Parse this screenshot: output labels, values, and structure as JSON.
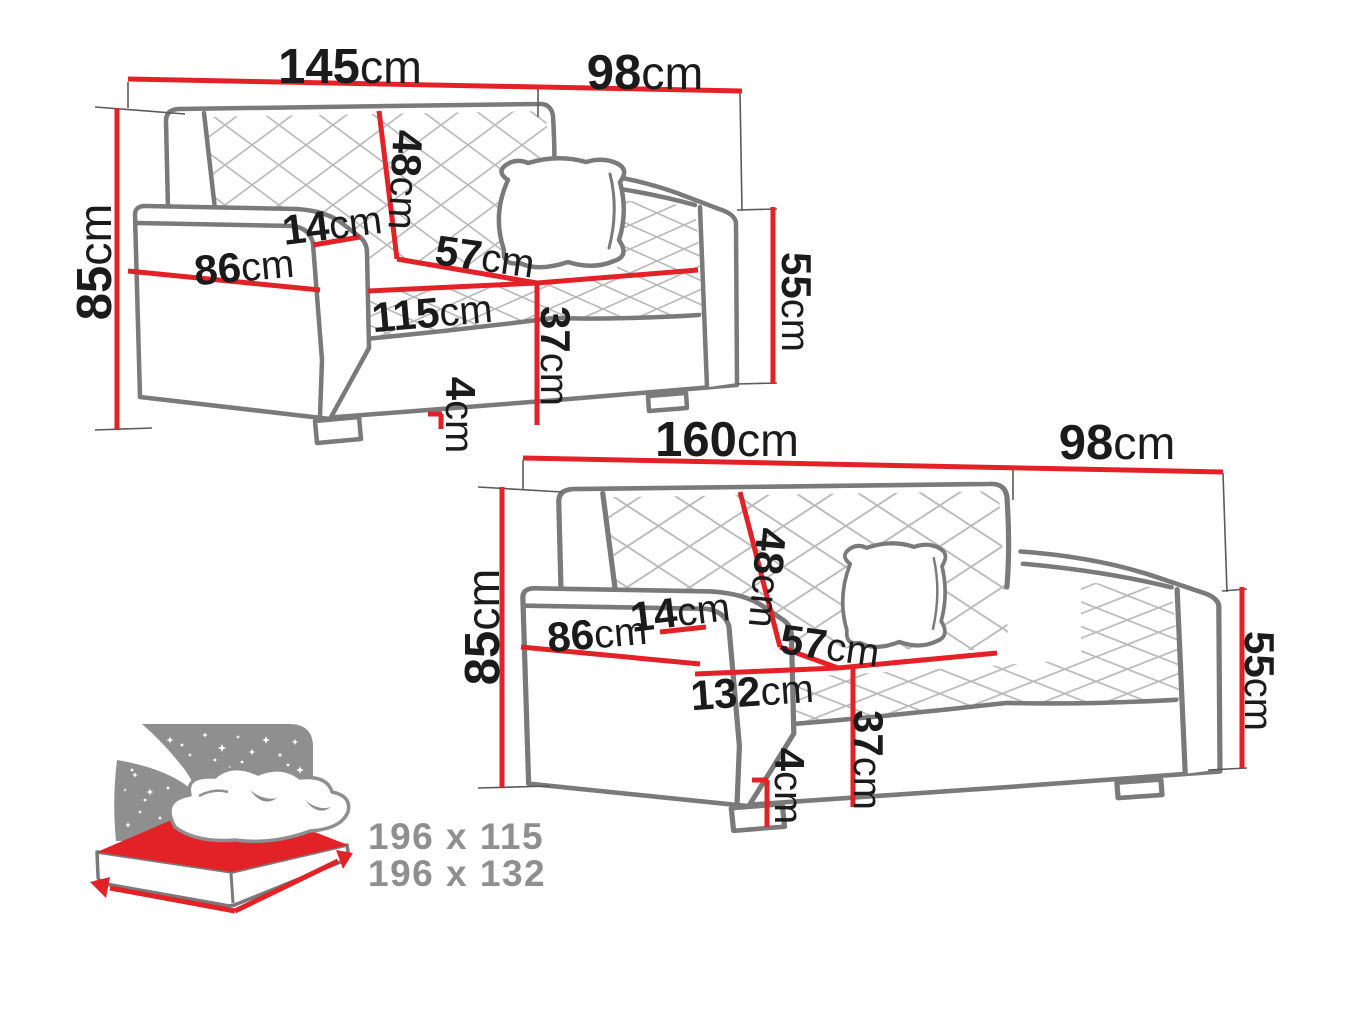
{
  "diagram_title": "sofa-dimensions-diagram",
  "colors": {
    "dimension_red": "#e32228",
    "outline_gray": "#7a7a7a",
    "quilt_gray": "#b9b9b9",
    "text_black": "#1b1b1b",
    "bed_gray": "#8f8f8f"
  },
  "sofa_small": {
    "overall_width": {
      "value": "145",
      "unit": "cm"
    },
    "overall_depth": {
      "value": "98",
      "unit": "cm"
    },
    "overall_height": {
      "value": "85",
      "unit": "cm"
    },
    "backrest_height": {
      "value": "48",
      "unit": "cm"
    },
    "armrest_width": {
      "value": "14",
      "unit": "cm"
    },
    "armrest_depth": {
      "value": "86",
      "unit": "cm"
    },
    "seat_depth": {
      "value": "57",
      "unit": "cm"
    },
    "seat_width": {
      "value": "115",
      "unit": "cm"
    },
    "seat_height": {
      "value": "37",
      "unit": "cm"
    },
    "leg_height": {
      "value": "4",
      "unit": "cm"
    },
    "armrest_height": {
      "value": "55",
      "unit": "cm"
    }
  },
  "sofa_large": {
    "overall_width": {
      "value": "160",
      "unit": "cm"
    },
    "overall_depth": {
      "value": "98",
      "unit": "cm"
    },
    "overall_height": {
      "value": "85",
      "unit": "cm"
    },
    "backrest_height": {
      "value": "48",
      "unit": "cm"
    },
    "armrest_width": {
      "value": "14",
      "unit": "cm"
    },
    "armrest_depth": {
      "value": "86",
      "unit": "cm"
    },
    "seat_depth": {
      "value": "57",
      "unit": "cm"
    },
    "seat_width": {
      "value": "132",
      "unit": "cm"
    },
    "seat_height": {
      "value": "37",
      "unit": "cm"
    },
    "leg_height": {
      "value": "4",
      "unit": "cm"
    },
    "armrest_height": {
      "value": "55",
      "unit": "cm"
    }
  },
  "bed_icon": {
    "sleeping_area_small": "196 x 115",
    "sleeping_area_large": "196 x 132"
  }
}
